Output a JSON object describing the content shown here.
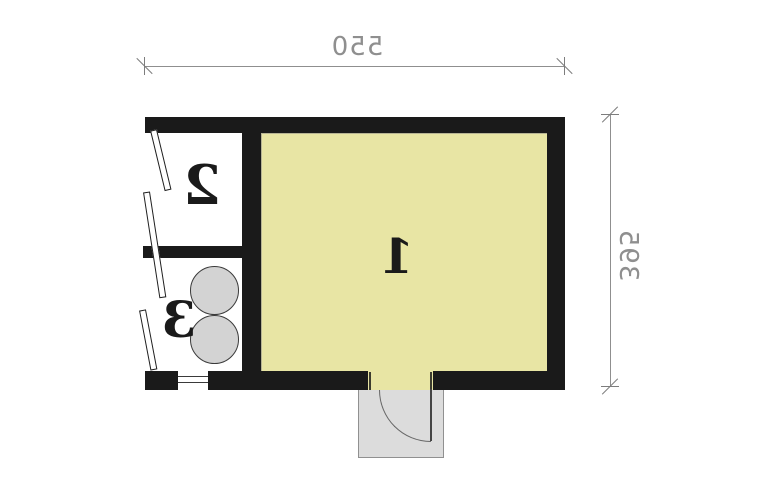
{
  "plan": {
    "type": "mirrored architectural floor plan",
    "rooms": [
      {
        "id": 1,
        "label": "1"
      },
      {
        "id": 2,
        "label": "2"
      },
      {
        "id": 3,
        "label": "3"
      }
    ],
    "dimensions": {
      "width_label": "550",
      "height_label": "395"
    },
    "colors": {
      "wall": "#1a1a1a",
      "main_room_floor": "#e8e5a4",
      "side_room_floor": "#ffffff",
      "fixture_fill": "#d3d3d3",
      "porch_fill": "#dcdcdc",
      "dimension": "#8f8f8f",
      "background": "#ffffff"
    }
  }
}
